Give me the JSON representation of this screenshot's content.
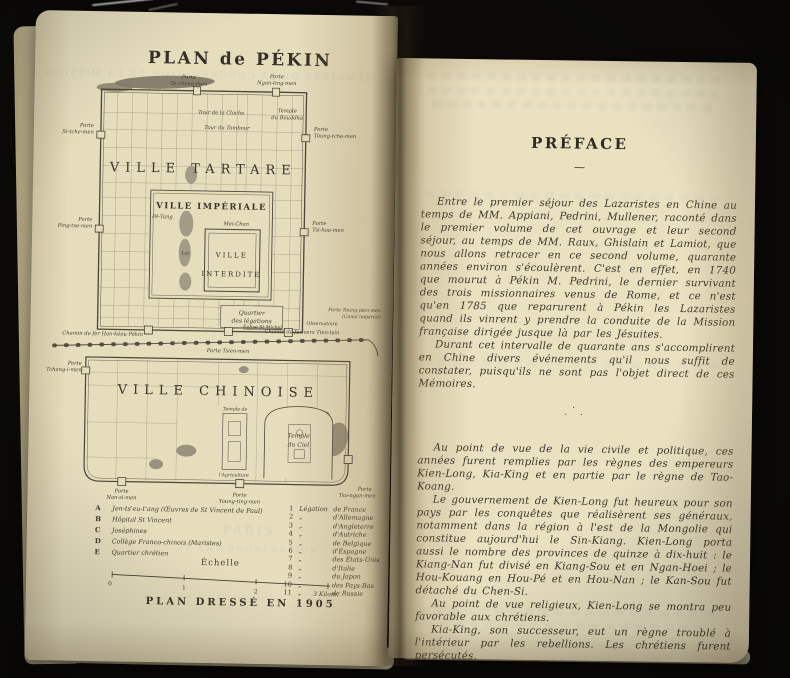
{
  "left_page": {
    "title": "PLAN de PÉKIN",
    "map_labels": {
      "porte": "Porte",
      "ville_tartare": "VILLE TARTARE",
      "ville_imperiale": "VILLE IMPÉRIALE",
      "ville_interdite_1": "VILLE",
      "ville_interdite_2": "INTERDITE",
      "ville_chinoise": "VILLE CHINOISE",
      "mei_chan": "Mei-Chan",
      "lac": "Lac",
      "pe_tang": "Pé-Tang",
      "tour_cloche": "Tour de la Cloche",
      "tour_tambour": "Tour du Tambour",
      "temple_bouddha_1": "Temple",
      "temple_bouddha_2": "du Bouddha",
      "quartier_1": "Quartier",
      "quartier_2": "des légations",
      "eglise_st_michel": "Église St Michel",
      "observatoire": "Observatoire",
      "temple_ciel_1": "Temple",
      "temple_ciel_2": "du Ciel",
      "temple_agri_1": "Temple de",
      "temple_agri_2": "l'Agriculture",
      "chemin_ouest": "Chemin de fer Han-kéou Pékin",
      "chemin_est": "Chemin de fer vers Tien-tsin",
      "te_cheng": "Te-cheng-men",
      "ngan_ting": "Ngan-ting-men",
      "si_tche": "Si-tche-men",
      "ping_tse": "Ping-tse-men",
      "toung_tche": "Toung-tche-men",
      "tsi_hoa": "Tsi-hoa-men",
      "tsien_full": "Porte Tsien-men",
      "tchang_i": "Tchang-i-men",
      "toung_pien_1": "Porte Toung-pien-men",
      "toung_pien_2": "(Canal impérial)",
      "nan_si": "Nan-si-men",
      "young_ting": "Young-ting-men",
      "tso_ngan": "Tso-ngan-men"
    },
    "legend_letters": [
      {
        "key": "A",
        "label": "Jen-ts'eu-t'ang (Œuvres de St Vincent de Paul)"
      },
      {
        "key": "B",
        "label": "Hôpital St Vincent"
      },
      {
        "key": "C",
        "label": "Joséphines"
      },
      {
        "key": "D",
        "label": "Collège Franco-chinois (Maristes)"
      },
      {
        "key": "E",
        "label": "Quartier chrétien"
      }
    ],
    "legend_numbers": [
      {
        "n": "1",
        "a": "Légation",
        "b": "de France"
      },
      {
        "n": "2",
        "a": "„",
        "b": "d'Allemagne"
      },
      {
        "n": "3",
        "a": "„",
        "b": "d'Angleterre"
      },
      {
        "n": "4",
        "a": "„",
        "b": "d'Autriche"
      },
      {
        "n": "5",
        "a": "„",
        "b": "de Belgique"
      },
      {
        "n": "6",
        "a": "„",
        "b": "d'Espagne"
      },
      {
        "n": "7",
        "a": "„",
        "b": "des États-Unis"
      },
      {
        "n": "8",
        "a": "„",
        "b": "d'Italie"
      },
      {
        "n": "9",
        "a": "„",
        "b": "du Japon"
      },
      {
        "n": "10",
        "a": "„",
        "b": "des Pays-Bas"
      },
      {
        "n": "11",
        "a": "„",
        "b": "de Russie"
      }
    ],
    "scale_label": "Échelle",
    "scale_ticks": [
      "0",
      "1",
      "2",
      "3 Kilom."
    ],
    "caption": "PLAN DRESSÉ EN 1905",
    "bleedthrough": {
      "top": "MÉMOIRES DE LA CONGRÉGATION DE LA MISSION",
      "mid1": "PARIS",
      "mid2": "DE LA CONGRÉGATION"
    }
  },
  "right_page": {
    "heading": "PRÉFACE",
    "divider": "—",
    "block1": [
      "Entre le premier séjour des Lazaristes en Chine au temps de MM. Appiani, Pedrini, Mullener, raconté dans le premier volume de cet ouvrage et leur second séjour, au temps de MM. Raux, Ghislain et Lamiot, que nous allons retracer en ce second volume, quarante années environ s'écoulèrent. C'est en effet, en 1740 que mourut à Pékin M. Pedrini, le dernier survivant des trois missionnaires venus de Rome, et ce n'est qu'en 1785 que reparurent à Pékin les Lazaristes quand ils vinrent y prendre la conduite de la Mission française dirigée jusque là par les Jésuites.",
      "Durant cet intervalle de quarante ans s'accomplirent en Chine divers événements qu'il nous suffit de constater, puisqu'ils ne sont pas l'objet direct de ces Mémoires."
    ],
    "block2": [
      "Au point de vue de la vie civile et politique, ces années furent remplies par les règnes des empereurs Kien-Long, Kia-King et en partie par le règne de Tao-Koang.",
      "Le gouvernement de Kien-Long fut heureux pour son pays par les conquêtes que réalisèrent ses généraux, notamment dans la région à l'est de la Mongolie qui constitue aujourd'hui le Sin-Kiang. Kien-Long porta aussi le nombre des provinces de quinze à dix-huit : le Kiang-Nan fut divisé en Kiang-Sou et en Ngan-Hoei ; le Hou-Kouang en Hou-Pé et en Hou-Nan ; le Kan-Sou fut détaché du Chen-Si.",
      "Au point de vue religieux, Kien-Long se montra peu favorable aux chrétiens.",
      "Kia-King, son successeur, eut un règne troublé à l'intérieur par les rebellions. Les chrétiens furent persécutés."
    ],
    "asterism": {
      "top": "·",
      "bottom": "· ·"
    }
  }
}
